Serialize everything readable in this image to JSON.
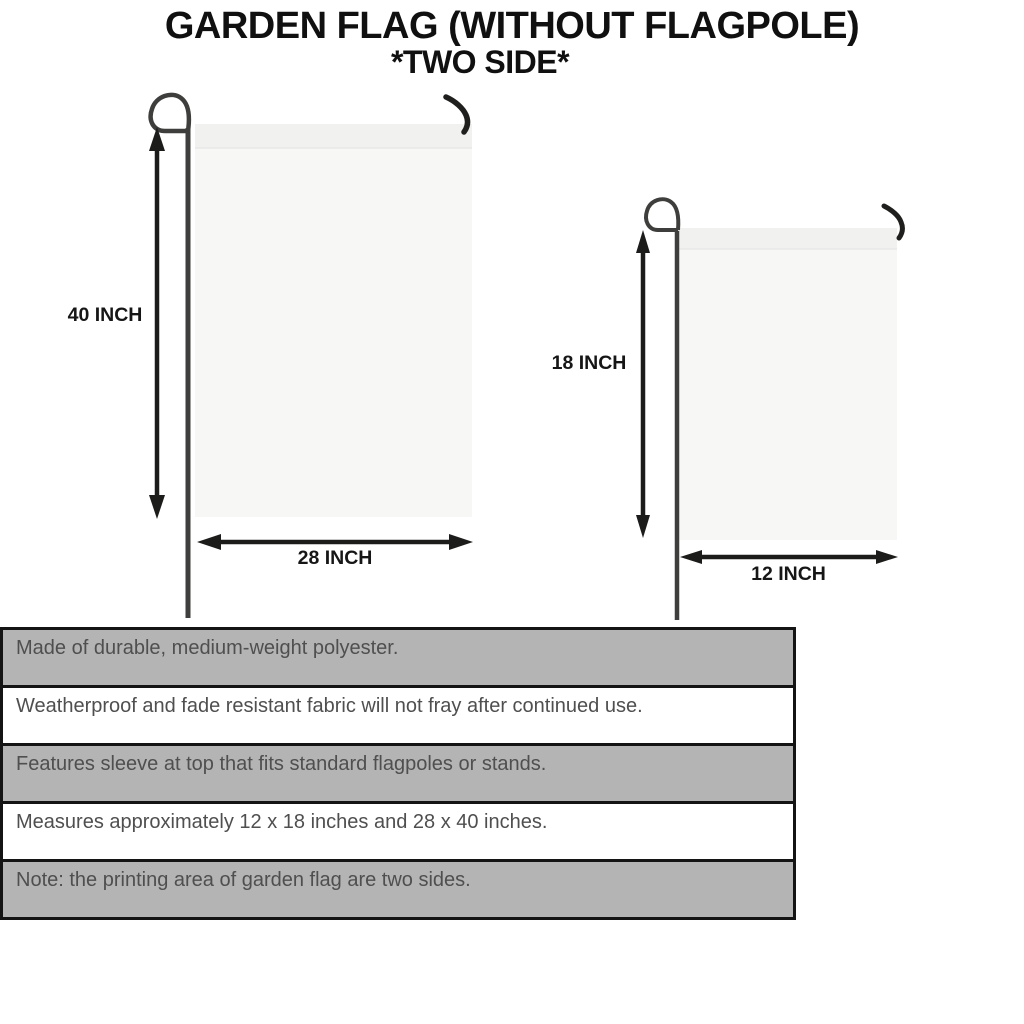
{
  "title": {
    "line1": "GARDEN FLAG (WITHOUT FLAGPOLE)",
    "line2": "*TWO SIDE*"
  },
  "large_flag": {
    "height_label": "40 INCH",
    "width_label": "28 INCH"
  },
  "small_flag": {
    "height_label": "18 INCH",
    "width_label": "12 INCH"
  },
  "features": {
    "rows": [
      {
        "text": "Made of durable, medium-weight polyester.",
        "shaded": true
      },
      {
        "text": "Weatherproof and fade resistant fabric will not fray after continued use.",
        "shaded": false
      },
      {
        "text": "Features sleeve at top that fits standard flagpoles or stands.",
        "shaded": true
      },
      {
        "text": "Measures approximately 12 x 18 inches and 28 x 40 inches.",
        "shaded": false
      },
      {
        "text": "Note: the printing area of garden flag are two sides.",
        "shaded": true
      }
    ]
  },
  "colors": {
    "row_shaded": "#b4b4b4",
    "row_plain": "#ffffff",
    "row_text": "#4f4f4f",
    "table_border": "#141414",
    "flag_fill": "#f7f7f6",
    "flag_sleeve": "#f1f1f0",
    "pole": "#3e3e3c",
    "arrow": "#1c1c1a",
    "title_text": "#101010"
  }
}
